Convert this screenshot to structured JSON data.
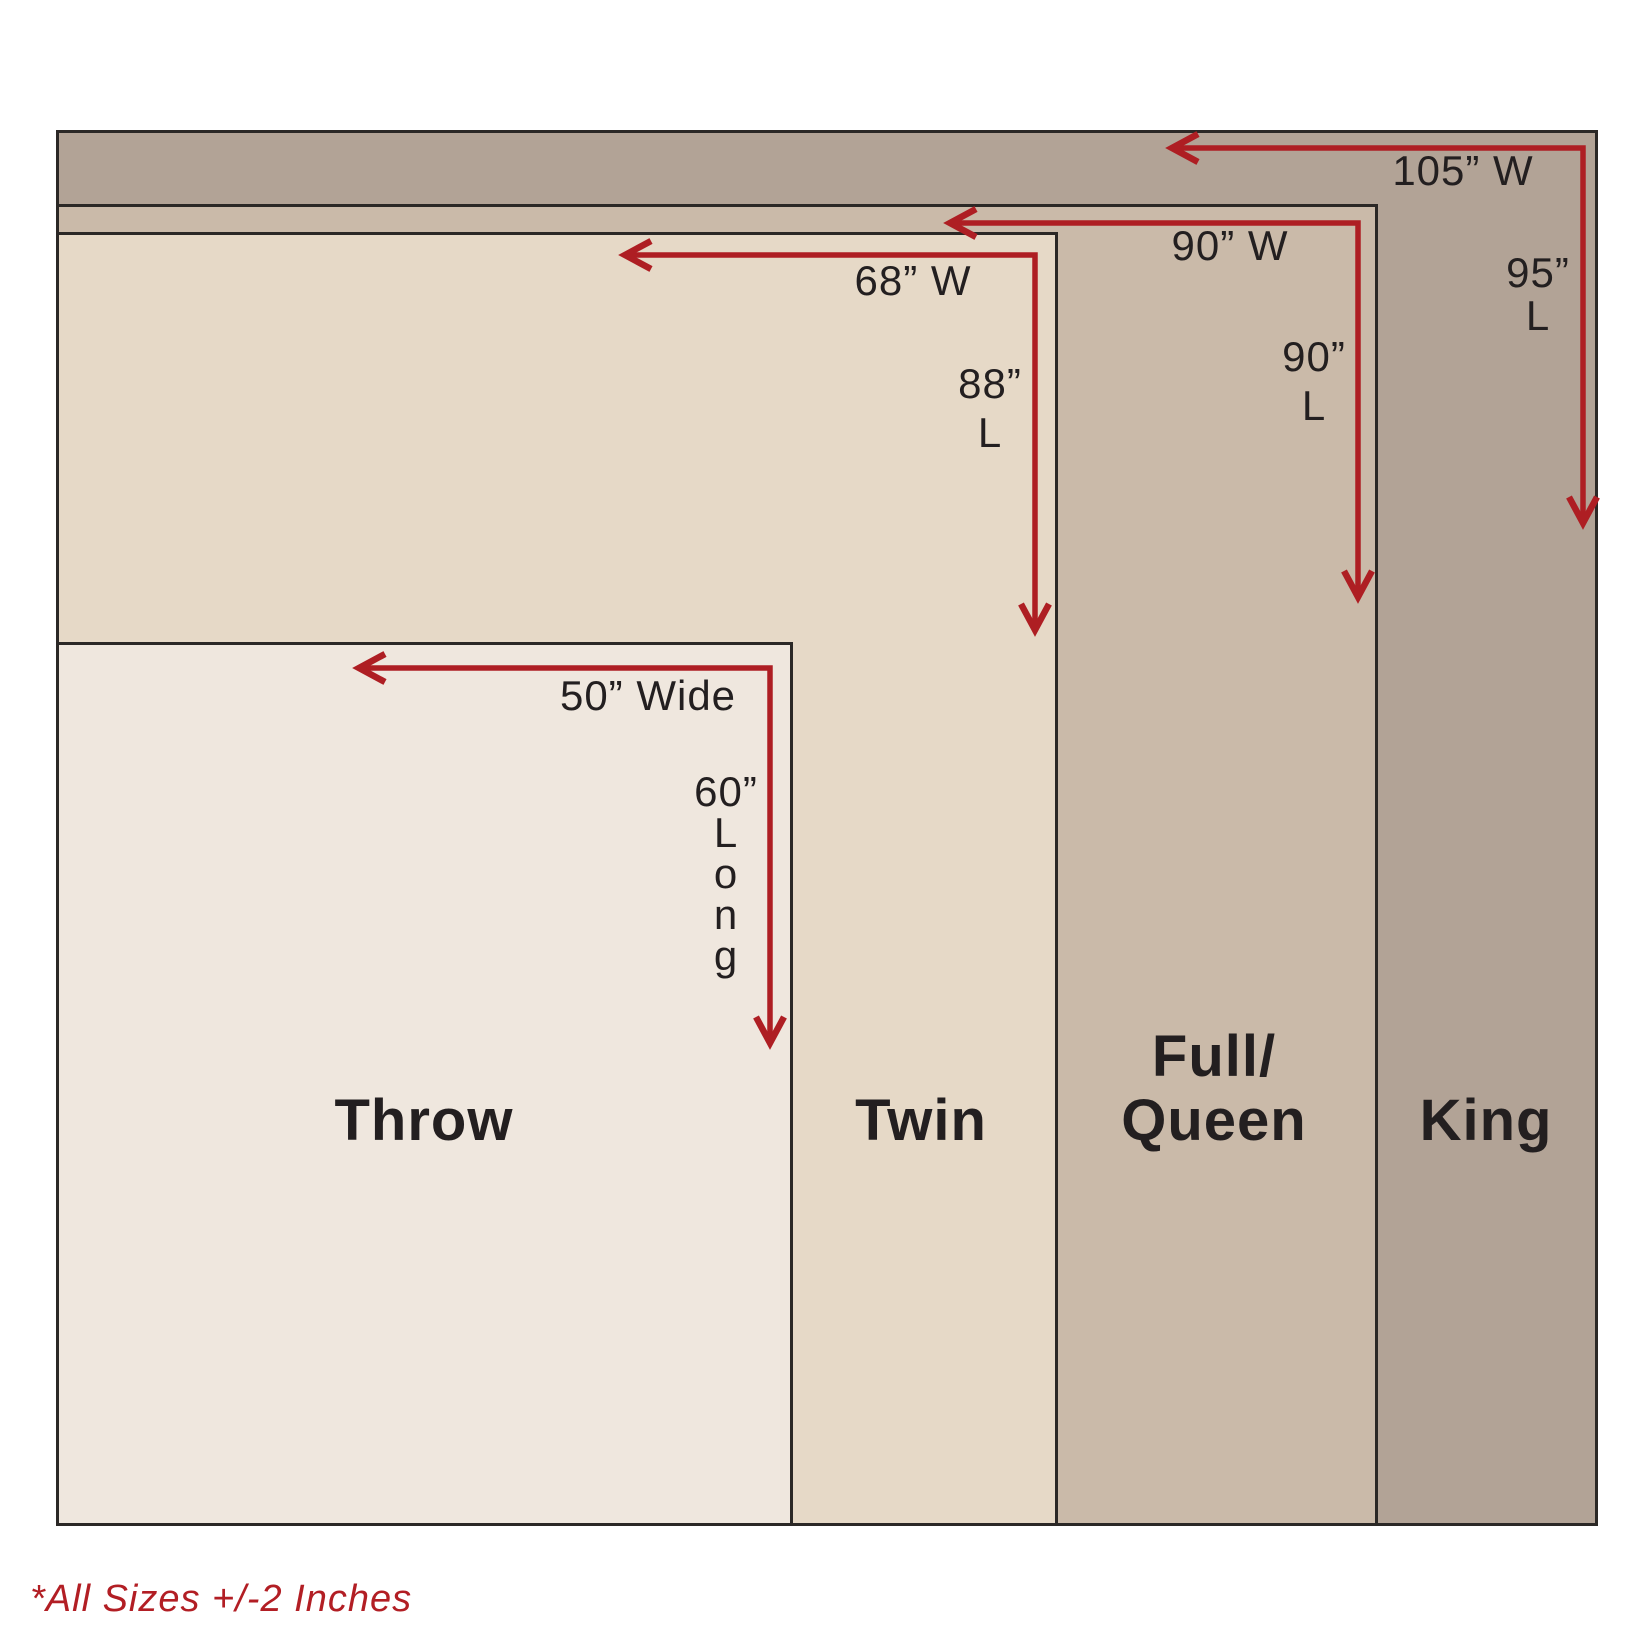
{
  "colors": {
    "arrow": "#ae1e23",
    "footnote": "#b21e24",
    "border": "#2b2826",
    "label_text": "#231f20",
    "background": "#ffffff"
  },
  "sizes": [
    {
      "name": "Throw",
      "fill": "#efe7de",
      "width_inches": 50,
      "length_inches": 60,
      "width_label": "50” Wide",
      "length_label": "60”\nL\no\nn\ng"
    },
    {
      "name": "Twin",
      "fill": "#e6d9c7",
      "width_inches": 68,
      "length_inches": 88,
      "width_label": "68” W",
      "length_label": "88”\nL"
    },
    {
      "name": "Full/\nQueen",
      "fill": "#cabaa9",
      "width_inches": 90,
      "length_inches": 90,
      "width_label": "90” W",
      "length_label": "90”\nL"
    },
    {
      "name": "King",
      "fill": "#b2a396",
      "width_inches": 105,
      "length_inches": 95,
      "width_label": "105” W",
      "length_label": "95”\nL"
    }
  ],
  "footnote": "*All Sizes +/-2 Inches"
}
